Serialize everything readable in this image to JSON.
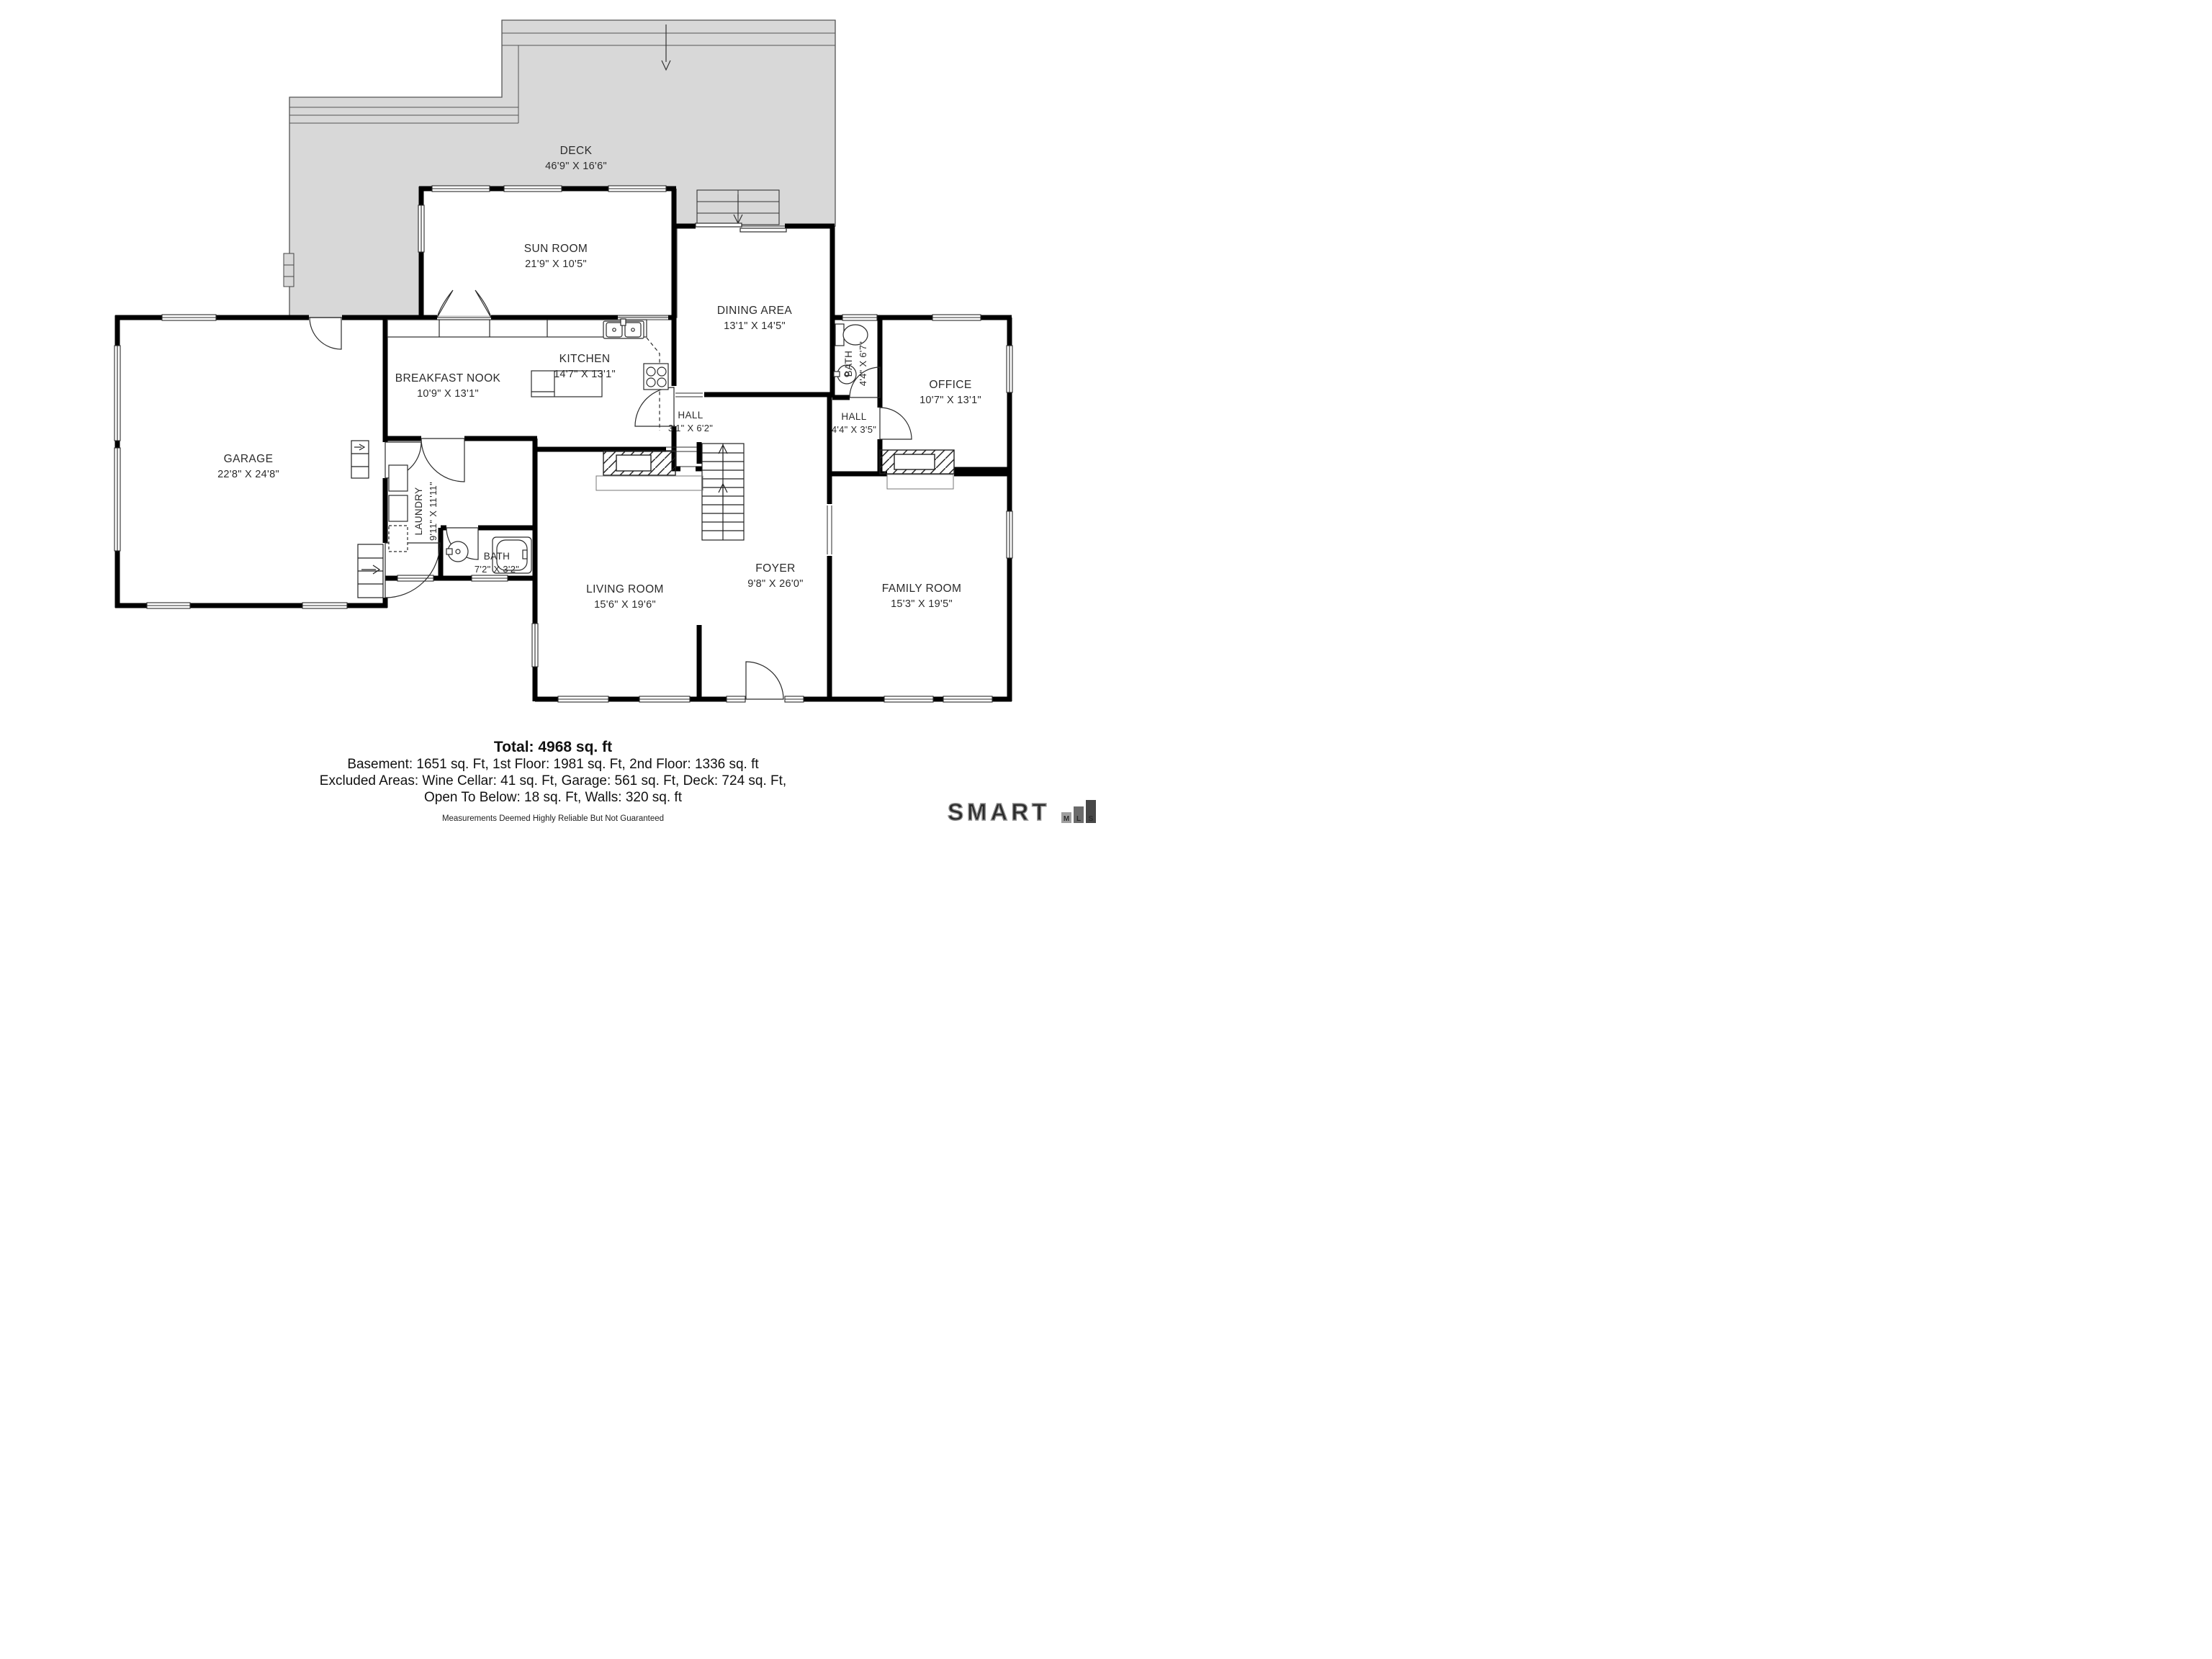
{
  "plan": {
    "rooms": {
      "deck": {
        "name": "DECK",
        "dims": "46'9\" X 16'6\""
      },
      "sun_room": {
        "name": "SUN ROOM",
        "dims": "21'9\" X 10'5\""
      },
      "dining": {
        "name": "DINING AREA",
        "dims": "13'1\" X 14'5\""
      },
      "kitchen": {
        "name": "KITCHEN",
        "dims": "14'7\" X 13'1\""
      },
      "breakfast": {
        "name": "BREAKFAST NOOK",
        "dims": "10'9\" X 13'1\""
      },
      "garage": {
        "name": "GARAGE",
        "dims": "22'8\" X 24'8\""
      },
      "laundry": {
        "name": "LAUNDRY",
        "dims": "9'11\" X 11'11\""
      },
      "bath_upper": {
        "name": "BATH",
        "dims": "4'4\" X 6'7\""
      },
      "bath_lower": {
        "name": "BATH",
        "dims": "7'2\" X 3'2\""
      },
      "hall_upper": {
        "name": "HALL",
        "dims": "3'1\" X 6'2\""
      },
      "hall_right": {
        "name": "HALL",
        "dims": "4'4\" X 3'5\""
      },
      "office": {
        "name": "OFFICE",
        "dims": "10'7\" X 13'1\""
      },
      "living": {
        "name": "LIVING ROOM",
        "dims": "15'6\" X 19'6\""
      },
      "foyer": {
        "name": "FOYER",
        "dims": "9'8\" X 26'0\""
      },
      "family": {
        "name": "FAMILY ROOM",
        "dims": "15'3\" X 19'5\""
      }
    }
  },
  "footer": {
    "total": "Total: 4968 sq. ft",
    "line1": "Basement: 1651 sq. Ft, 1st Floor: 1981 sq. Ft, 2nd Floor: 1336 sq. ft",
    "line2": "Excluded Areas: Wine Cellar: 41 sq. Ft, Garage: 561 sq. Ft, Deck: 724 sq. Ft,",
    "line3": "Open To Below: 18 sq. Ft, Walls: 320 sq. ft",
    "disclaimer": "Measurements Deemed Highly Reliable But Not Guaranteed"
  },
  "branding": {
    "word": "SMART",
    "m": "M",
    "l": "L",
    "s": "S"
  }
}
